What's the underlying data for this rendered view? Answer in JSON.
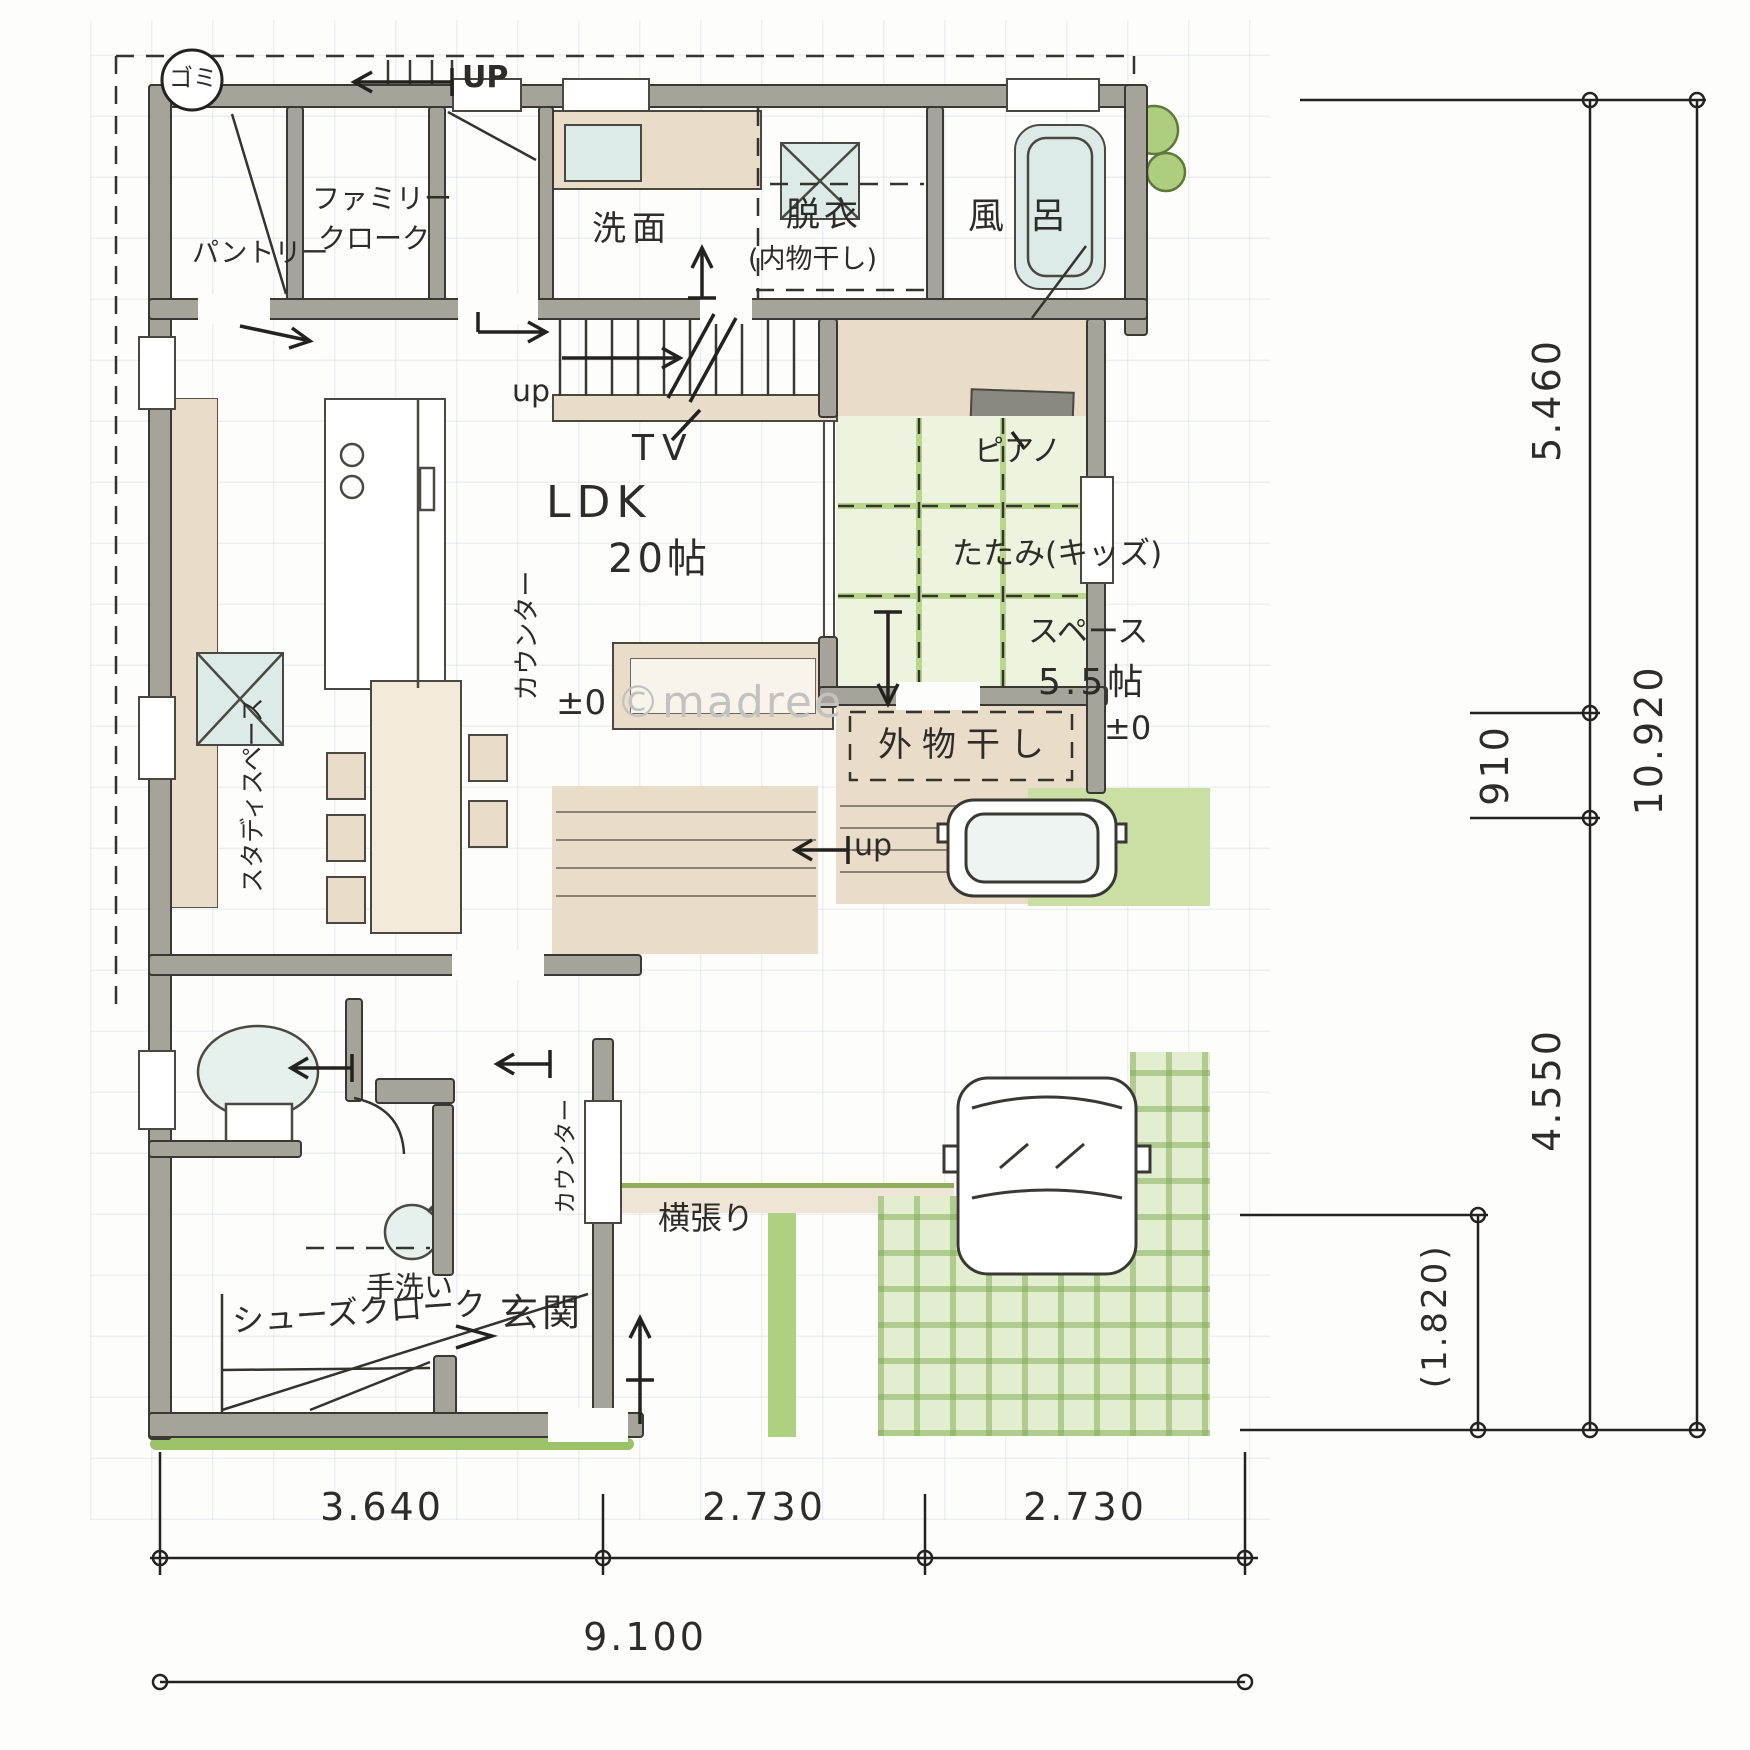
{
  "watermark": "©madree",
  "plan": {
    "trash": "ゴミ",
    "up_top": "UP",
    "pantry": "パントリー",
    "family_closet_line1": "ファミリー",
    "family_closet_line2": "クローク",
    "washroom": "洗面",
    "dressing_room_line1": "脱衣",
    "dressing_room_line2": "(内物干し)",
    "bath_char1": "風",
    "bath_char2": "呂",
    "stairs_up": "up",
    "tv": "TV",
    "ldk": "LDK",
    "ldk_size": "20帖",
    "ldk_level": "±0",
    "kitchen_counter": "カウンター",
    "study_space": "スタディスペース",
    "piano": "ピアノ",
    "tatami_line1": "たたみ(キッズ)",
    "tatami_line2": "スペース",
    "tatami_size": "5.5帖",
    "tatami_level": "±0",
    "outdoor_laundry": "外物干し",
    "deck_up": "up",
    "hand_wash": "手洗い",
    "shoe_closet": "シューズクローク",
    "entrance": "玄関",
    "entrance_counter": "カウンター",
    "exterior_siding": "横張り"
  },
  "dimensions": {
    "bottom_segments": [
      "3.640",
      "2.730",
      "2.730"
    ],
    "bottom_total": "9.100",
    "right_segments": [
      "5.460",
      "910",
      "4.550"
    ],
    "right_total": "10.920",
    "right_sub": "(1.820)"
  }
}
